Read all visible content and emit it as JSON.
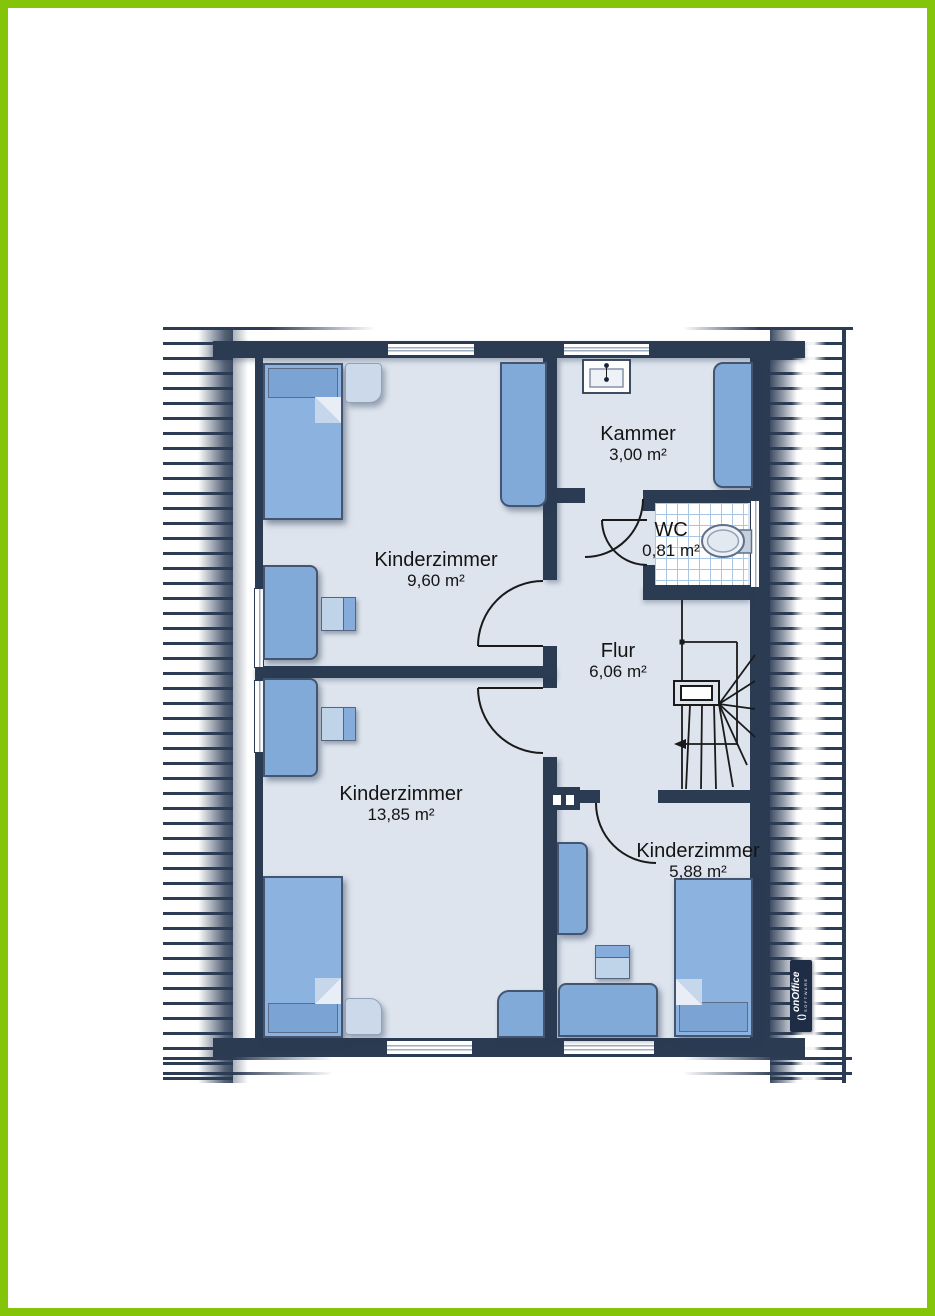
{
  "plan": {
    "type": "floor-plan",
    "rooms": [
      {
        "id": "kinderzimmer-1",
        "name": "Kinderzimmer",
        "area": "9,60 m²"
      },
      {
        "id": "kammer",
        "name": "Kammer",
        "area": "3,00 m²"
      },
      {
        "id": "wc",
        "name": "WC",
        "area": "0,81 m²"
      },
      {
        "id": "flur",
        "name": "Flur",
        "area": "6,06 m²"
      },
      {
        "id": "kinderzimmer-2",
        "name": "Kinderzimmer",
        "area": "13,85 m²"
      },
      {
        "id": "kinderzimmer-3",
        "name": "Kinderzimmer",
        "area": "5,88 m²"
      }
    ],
    "icons": [
      "bed-icon",
      "pillow-icon",
      "blanket-fold-icon",
      "nightstand-icon",
      "wardrobe-icon",
      "desk-icon",
      "chair-icon",
      "sink-icon",
      "toilet-icon",
      "stairs-icon",
      "direction-arrow-icon",
      "chimney-icon",
      "window-icon",
      "door-swing-icon",
      "roof-hatching"
    ],
    "colors": {
      "frame_green": "#84c50a",
      "wall_navy": "#2b3b52",
      "floor": "#dde4ee",
      "furniture_blue": "#82aad9",
      "furniture_light": "#ccd9ea",
      "tile_line": "#a9c7e5"
    },
    "logo": {
      "glyph": "( )",
      "brand": "onOffice",
      "sub": "SOFTWARE"
    }
  }
}
